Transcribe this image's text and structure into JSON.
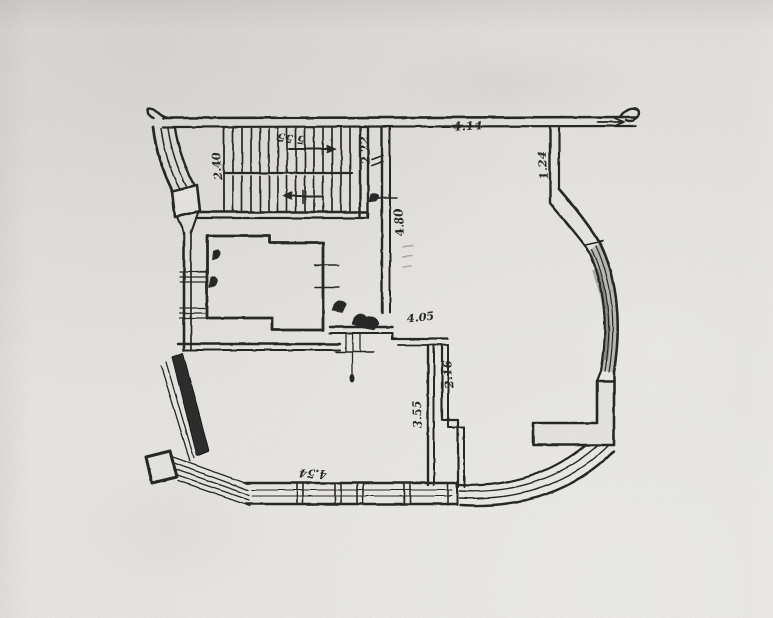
{
  "drawing": {
    "kind": "scanned architectural floor plan, ink on aged paper",
    "paper_color": "#e8e6e2",
    "ink_color": "#1d1d1d",
    "window_shade_color": "#4a4a4a",
    "labels": [
      {
        "id": "stair-top-dimension",
        "text": "5.55"
      },
      {
        "id": "stair-left-dimension",
        "text": "2.40"
      },
      {
        "id": "stair-right-dimension",
        "text": "2.22"
      },
      {
        "id": "right-room-top-dimension",
        "text": "4.14"
      },
      {
        "id": "corridor-wall-dimension",
        "text": "4.80"
      },
      {
        "id": "right-wall-dimension",
        "text": "1.24"
      },
      {
        "id": "hall-dimension",
        "text": "4.05"
      },
      {
        "id": "shaft-dimension",
        "text": "2.16"
      },
      {
        "id": "lower-room-right-dimension",
        "text": "3.55"
      },
      {
        "id": "bottom-wall-dimension",
        "text": "4.54"
      }
    ]
  }
}
